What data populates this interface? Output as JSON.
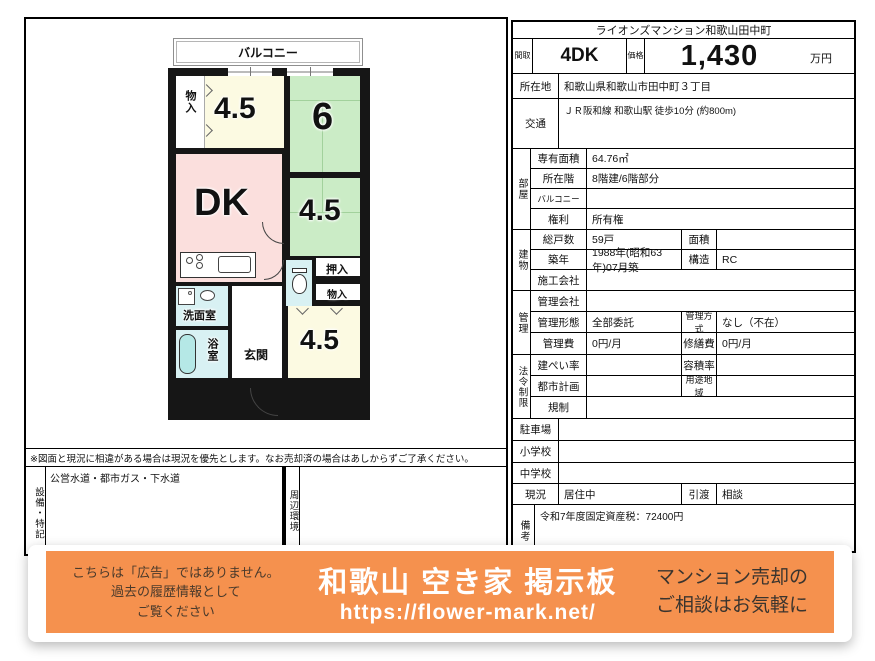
{
  "colors": {
    "banner-orange": "#f5914e",
    "room-cream": "#fcfae2",
    "room-green": "#cbecc6",
    "room-pink": "#fbdfdd",
    "room-blue": "#d8f1f3",
    "tub-cyan": "#b5e8e6"
  },
  "floorplan": {
    "balcony": "バルコニー",
    "storage_top": "物入",
    "room45_top": "4.5",
    "room6": "6",
    "dk": "DK",
    "room45_mid": "4.5",
    "oshiire": "押入",
    "storage_mid": "物入",
    "washroom": "洗面室",
    "bathroom": "浴室",
    "entrance": "玄関",
    "room45_bottom": "4.5",
    "note": "※図面と現況に相違がある場合は現況を優先とします。なお売却済の場合はあしからずご了承ください。",
    "equipment_label": "設備・特記",
    "equipment_value": "公営水道・都市ガス・下水道",
    "surroundings_label": "周辺環境"
  },
  "table": {
    "title": "ライオンズマンション和歌山田中町",
    "madori": {
      "label": "間取",
      "value": "4DK"
    },
    "price": {
      "label": "価格",
      "value": "1,430",
      "unit": "万円"
    },
    "location": {
      "label": "所在地",
      "value": "和歌山県和歌山市田中町３丁目"
    },
    "access": {
      "label": "交通",
      "value": "ＪＲ阪和線 和歌山駅 徒歩10分 (約800m)"
    },
    "room": {
      "section": "部屋",
      "area": {
        "label": "専有面積",
        "value": "64.76㎡"
      },
      "floor": {
        "label": "所在階",
        "value": "8階建/6階部分"
      },
      "balcony": {
        "label": "バルコニー",
        "value": ""
      },
      "rights": {
        "label": "権利",
        "value": "所有権"
      }
    },
    "building": {
      "section": "建物",
      "units": {
        "label": "総戸数",
        "value": "59戸"
      },
      "menseki": {
        "label": "面積",
        "value": ""
      },
      "built": {
        "label": "築年",
        "value": "1988年(昭和63年)07月築"
      },
      "structure": {
        "label": "構造",
        "value": "RC"
      },
      "contractor": {
        "label": "施工会社",
        "value": ""
      }
    },
    "management": {
      "section": "管理",
      "company": {
        "label": "管理会社",
        "value": ""
      },
      "keitai": {
        "label": "管理形態",
        "value": "全部委託"
      },
      "houshiki": {
        "label": "管理方式",
        "value": "なし（不在）"
      },
      "fee": {
        "label": "管理費",
        "value": "0円/月"
      },
      "shuzen": {
        "label": "修繕費",
        "value": "0円/月"
      }
    },
    "legal": {
      "section": "法令制限",
      "kenpei": {
        "label": "建ぺい率",
        "value": ""
      },
      "yoseki": {
        "label": "容積率",
        "value": ""
      },
      "toshikeikaku": {
        "label": "都市計画",
        "value": ""
      },
      "yoto": {
        "label": "用途地域",
        "value": ""
      },
      "kisei": {
        "label": "規制",
        "value": ""
      }
    },
    "parking": {
      "label": "駐車場",
      "value": ""
    },
    "elementary": {
      "label": "小学校",
      "value": ""
    },
    "junior_high": {
      "label": "中学校",
      "value": ""
    },
    "genkyo": {
      "label": "現況",
      "value": "居住中"
    },
    "hikiwatashi": {
      "label": "引渡",
      "value": "相談"
    },
    "biko": {
      "label": "備考",
      "value": "令和7年度固定資産税：72400円"
    }
  },
  "banner": {
    "disclaimer_line1": "こちらは「広告」ではありません。",
    "disclaimer_line2": "過去の履歴情報として",
    "disclaimer_line3": "ご覧ください",
    "site_title": "和歌山 空き家 掲示板",
    "site_url": "https://flower-mark.net/",
    "cta_line1": "マンション売却の",
    "cta_line2": "ご相談はお気軽に"
  }
}
